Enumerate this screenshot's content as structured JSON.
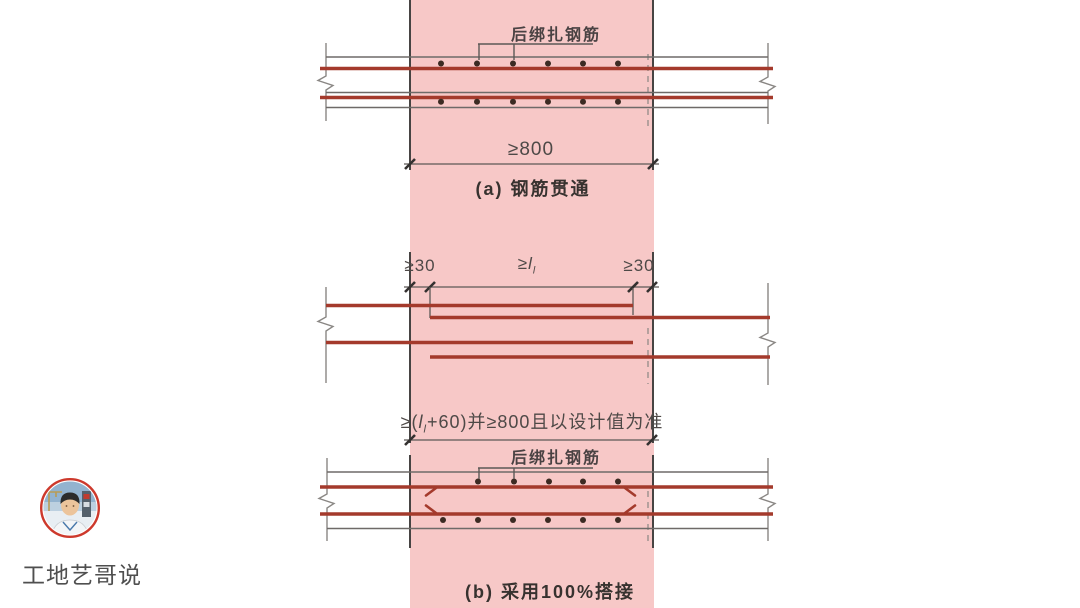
{
  "figure": {
    "section_a": {
      "rebar_label": "后绑扎钢筋",
      "width_dim": "≥800",
      "caption": "(a) 钢筋贯通"
    },
    "section_mid": {
      "dim_left": "≥30",
      "dim_right": "≥30",
      "lap_dim": {
        "ge": "≥",
        "sym": "l",
        "sub": "l"
      },
      "total_dim": {
        "pre": "≥(",
        "sym": "l",
        "sub": "l",
        "post": "+60)并≥800且以设计值为准"
      }
    },
    "section_b": {
      "rebar_label": "后绑扎钢筋",
      "caption": "(b) 采用100%搭接"
    }
  },
  "watermark": {
    "name": "工地艺哥说"
  },
  "colors": {
    "band_fill": "#f7c8c7",
    "rebar_red": "#a43a2c",
    "line_gray": "#6e6a68",
    "text": "#4e4947"
  }
}
